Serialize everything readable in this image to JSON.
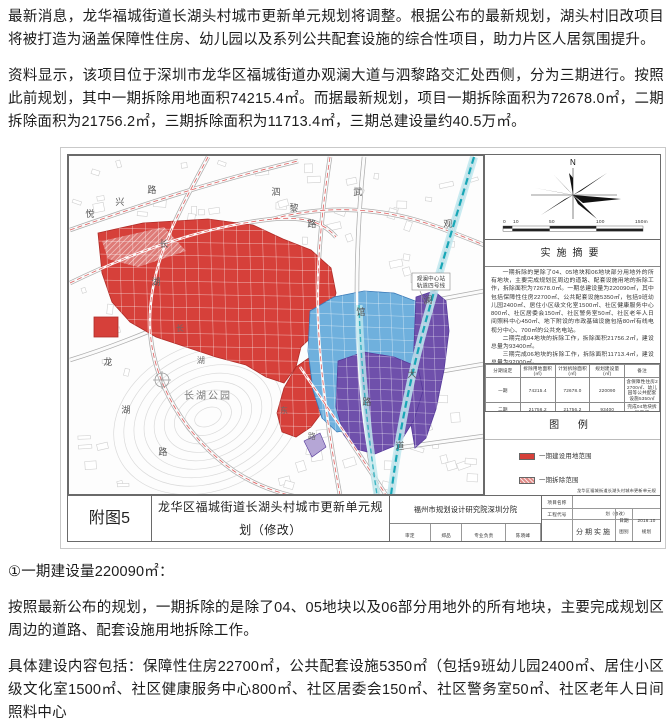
{
  "article": {
    "p1": "最新消息，龙华福城街道长湖头村城市更新单元规划将调整。根据公布的最新规划，湖头村旧改项目将被打造为涵盖保障性住房、幼儿园以及系列公共配套设施的综合性项目，助力片区人居氛围提升。",
    "p2": "资料显示，该项目位于深圳市龙华区福城街道办观澜大道与泗黎路交汇处西侧，分为三期进行。按照此前规划，其中一期拆除用地面积74215.4㎡。而据最新规划，项目一期拆除面积为72678.0㎡，二期拆除面积为21756.2㎡，三期拆除面积为11713.4㎡，三期总建设量约40.5万㎡。",
    "p3": "①一期建设量220090㎡：",
    "p4": "按照最新公布的规划，一期拆除的是除了04、05地块以及06部分用地外的所有地块，主要完成规划区周边的道路、配套设施用地拆除工作。",
    "p5": "具体建设内容包括：保障性住房22700㎡，公共配套设施5350㎡（包括9班幼儿园2400㎡、居住小区级文化室1500㎡、社区健康服务中心800㎡、社区居委会150㎡、社区警务室50㎡、社区老年人日间照料中心"
  },
  "colors": {
    "phase1_red": "#d6403a",
    "phase1_stroke": "#b02c28",
    "phase2_blue": "#6fb0dd",
    "phase2_stroke": "#3a7ab8",
    "phase2_build": "#2b5fae",
    "phase2_demolish": "#cfe9f0",
    "phase3_purple": "#6f50ab",
    "phase3_stroke": "#55399a",
    "phase3_demolish": "#b5a6d6",
    "rail_teal": "#18a6b6",
    "rail_band": "#bfe8ee",
    "dev_line_red": "#d04040",
    "public_service": "#d8f0f4"
  },
  "map": {
    "north_label": "N",
    "park_label": "长湖公园",
    "station_line1": "观澜中心站",
    "station_line2": "轨道四号线",
    "scale_ticks": [
      "0",
      "10",
      "50",
      "100",
      "150m"
    ],
    "char_labels": [
      {
        "ch": "悦",
        "x": 22,
        "y": 62
      },
      {
        "ch": "兴",
        "x": 52,
        "y": 50
      },
      {
        "ch": "路",
        "x": 84,
        "y": 38
      },
      {
        "ch": "长",
        "x": 96,
        "y": 92
      },
      {
        "ch": "湖",
        "x": 88,
        "y": 130
      },
      {
        "ch": "龙",
        "x": 40,
        "y": 210
      },
      {
        "ch": "湖",
        "x": 58,
        "y": 258
      },
      {
        "ch": "路",
        "x": 95,
        "y": 300
      },
      {
        "ch": "泗",
        "x": 208,
        "y": 40
      },
      {
        "ch": "黎",
        "x": 226,
        "y": 56
      },
      {
        "ch": "路",
        "x": 244,
        "y": 72
      },
      {
        "ch": "武",
        "x": 290,
        "y": 40
      },
      {
        "ch": "馆",
        "x": 293,
        "y": 160
      },
      {
        "ch": "路",
        "x": 299,
        "y": 250
      },
      {
        "ch": "观",
        "x": 380,
        "y": 72
      },
      {
        "ch": "澜",
        "x": 360,
        "y": 148
      },
      {
        "ch": "大",
        "x": 344,
        "y": 222
      },
      {
        "ch": "道",
        "x": 332,
        "y": 294
      },
      {
        "ch": "长",
        "x": 112,
        "y": 176,
        "s": 8,
        "c": "#6b6b6b"
      },
      {
        "ch": "湖",
        "x": 133,
        "y": 208,
        "s": 8,
        "c": "#6b6b6b"
      },
      {
        "ch": "东",
        "x": 216,
        "y": 258,
        "s": 8,
        "c": "#6b6b6b"
      },
      {
        "ch": "路",
        "x": 244,
        "y": 284,
        "s": 8,
        "c": "#6b6b6b"
      }
    ],
    "summary": {
      "title": "实施摘要",
      "p1": "一期拆除的是除了04、05地块和06地块部分用地外的所有地块，主要完成规划区周边的道路、配套设施用地的拆除工作，拆除面积为72678.0㎡。一期总建设量为220090㎡，其中包括保障性住房22700㎡、公共配套设施5350㎡，包括9班幼儿园2400㎡、居住小区级文化室1500㎡、社区健康服务中心800㎡、社区居委会150㎡、社区警务室50㎡、社区老年人日间照料中心450㎡、地下附设的市政基础设施包括80㎡有线电视分中心、700㎡的公共充电站。",
      "p2": "二期完成04地块的拆除工作，拆除面积21756.2㎡，建设总量为93400㎡。",
      "p3": "三期完成06地块的拆除工作，拆除面积11713.4㎡，建设总量为92000㎡。"
    },
    "phase_table": {
      "headers": [
        "分期设定",
        "拆除用地面积(㎡)",
        "计划拆除面积(㎡)",
        "规划建设量(㎡)",
        "备注"
      ],
      "rows": [
        [
          "一期",
          "74215.4",
          "72678.0",
          "220090",
          "含保障性住房22700㎡、幼儿园等公共配套设施5350㎡"
        ],
        [
          "二期",
          "21756.2",
          "21756.2",
          "93400",
          "完成04地块拆除工作"
        ],
        [
          "三期",
          "11713.4",
          "11713.4",
          "92000",
          "完成06地块拆除工作"
        ]
      ]
    },
    "legend": {
      "title": "图  例",
      "items": [
        {
          "label": "一期建设用地范围",
          "type": "solid",
          "color": "#d6403a"
        },
        {
          "label": "一期拆除范围",
          "type": "hatch",
          "color": "#e08a86"
        },
        {
          "label": "二期建设用地范围",
          "type": "solid",
          "color": "#2b5fae"
        },
        {
          "label": "二期拆除范围",
          "type": "solid",
          "color": "#cfe9f0"
        },
        {
          "label": "三期建设用地范围",
          "type": "solid",
          "color": "#6f50ab"
        },
        {
          "label": "三期拆除范围",
          "type": "hatch",
          "color": "#b5a6d6"
        },
        {
          "label": "轨道四号线",
          "type": "rail",
          "color": "#d8f0f4"
        },
        {
          "label": "拆除用地范围",
          "type": "dashline",
          "color": ""
        },
        {
          "label": "开发建设用地范围",
          "type": "redline",
          "color": ""
        },
        {
          "label": "公共服务设施用地范围",
          "type": "solid",
          "color": "#d8f0f4"
        },
        {
          "label": "地块编码／用地性质",
          "type": "code",
          "color": ""
        }
      ]
    },
    "titleblock": {
      "fig_no": "附图5",
      "title": "龙华区福城街道长湖头村城市更新单元规划（修改）",
      "institute": "福州市规划设计研究院深圳分院",
      "staff": [
        [
          "审定",
          "郑品",
          "专业负责",
          "陈晓峰"
        ],
        [
          "审核",
          "罗杏",
          "设 计",
          "李志平"
        ],
        [
          "项目负责",
          "李贤",
          "校 对",
          "钟丽娟"
        ]
      ],
      "project_label": "项目名称",
      "project_name": "龙华区福城街道长湖头村城市更新单元规划（修改）",
      "code_label": "工程代号",
      "date_label": "日期",
      "date_value": "2016.10",
      "sheet_label": "图纸名称",
      "sheet_name": "分期实施规划图",
      "type_label": "图别",
      "type_value": "规划",
      "no_label": "图号",
      "no_value": "附图5"
    }
  }
}
